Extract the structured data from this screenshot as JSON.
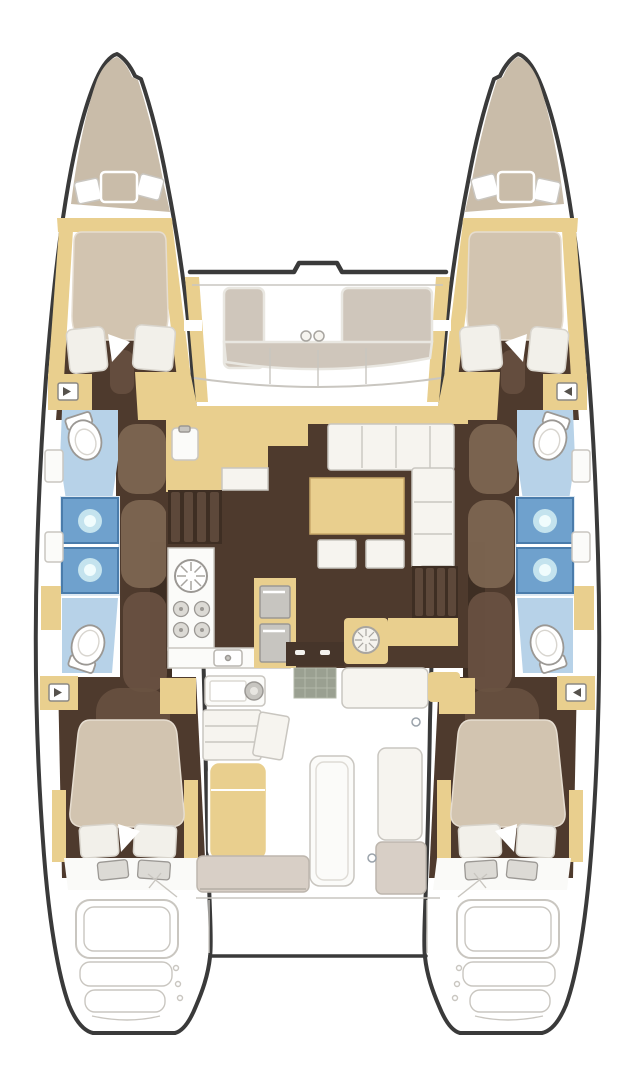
{
  "document": {
    "kind": "catamaran interior deck plan",
    "view": "top-down floor plan, bow up",
    "visible_text": "none"
  },
  "colors": {
    "outline": "#3a3a3a",
    "white": "#ffffff",
    "deckline": "#c9c6c0",
    "bow_fill": "#c9bca9",
    "pad_fill": "#cfc6bb",
    "pad_edge": "#e9e7e1",
    "bench_tan": "#d8cfc6",
    "bench_edge": "#bdb6ad",
    "wood": "#e9cf8e",
    "wood_edge": "#c9a96a",
    "floor": "#4e3a2d",
    "floor_dark": "#3e2e23",
    "stair_stripe": "#5d483a",
    "locker": "#7e6753",
    "locker_dark": "#6a5242",
    "bed": "#d2c4b0",
    "pillow": "#f2f0ea",
    "pillow_edge": "#d8d4cc",
    "sofa": "#f6f4ef",
    "sofa_edge": "#c9c6c0",
    "bath_floor": "#b7d2e8",
    "shower": "#6fa1cd",
    "shower_edge": "#4a7cab",
    "glow_mid": "#cdeaf2",
    "glow_core": "#f0fcfd",
    "counter": "#fbfbf9",
    "counter_edge": "#c9c6c0",
    "fixture": "#c7c5c0",
    "fixture_light": "#dcdad5",
    "fixture_edge": "#9b9894",
    "door": "#46352a",
    "mat": "#9aa091",
    "mat_line": "#b3b8a9"
  },
  "layout": {
    "hulls": [
      "port",
      "starboard"
    ],
    "areas": [
      "bow peak",
      "forward cabin",
      "forward head",
      "shower stalls",
      "aft head",
      "aft cabin",
      "transom steps",
      "foredeck lounge seat",
      "saloon",
      "galley",
      "nav station",
      "companionway stairs",
      "cockpit",
      "trampoline area"
    ],
    "fixtures": {
      "double_berths": 4,
      "pillows_per_berth": 2,
      "toilets": 4,
      "shower_stalls": 4,
      "galley_burners": 4,
      "galley_round_sink": 1,
      "fridge_drawers": 2,
      "saloon_table": 1,
      "ottomans": 2,
      "companionway_stairs": 2,
      "deck_hatches": 4,
      "sliding_door_handles": 2,
      "foredeck_deck_fittings": 2
    }
  }
}
